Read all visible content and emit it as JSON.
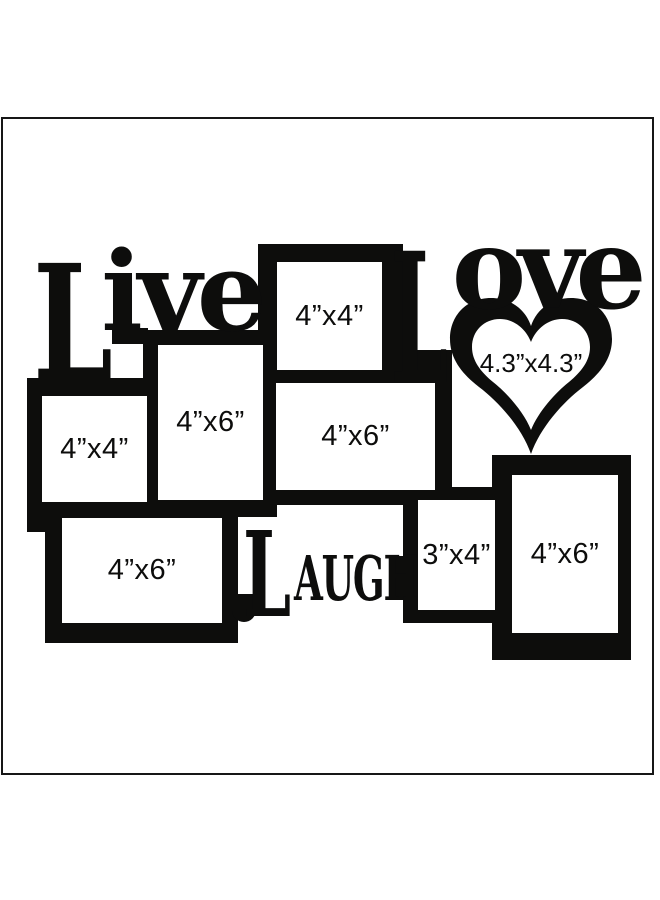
{
  "collage": {
    "words": {
      "live": {
        "initial": "L",
        "rest": "ive"
      },
      "love": {
        "initial": "L",
        "rest": "ove"
      },
      "laugh": {
        "initial": "L",
        "rest": "AUGH"
      }
    },
    "frames": [
      {
        "id": "top-square",
        "label": "4”x4”"
      },
      {
        "id": "left-square",
        "label": "4”x4”"
      },
      {
        "id": "upper-portrait",
        "label": "4”x6”"
      },
      {
        "id": "middle-landscape",
        "label": "4”x6”"
      },
      {
        "id": "heart",
        "label": "4.3”x4.3”"
      },
      {
        "id": "bottom-left-landscape",
        "label": "4”x6”"
      },
      {
        "id": "small-portrait",
        "label": "3”x4”"
      },
      {
        "id": "bottom-right-portrait",
        "label": "4”x6”"
      }
    ],
    "colors": {
      "silhouette": "#0d0d0c",
      "background": "#ffffff",
      "canvas_border": "#161616"
    }
  }
}
